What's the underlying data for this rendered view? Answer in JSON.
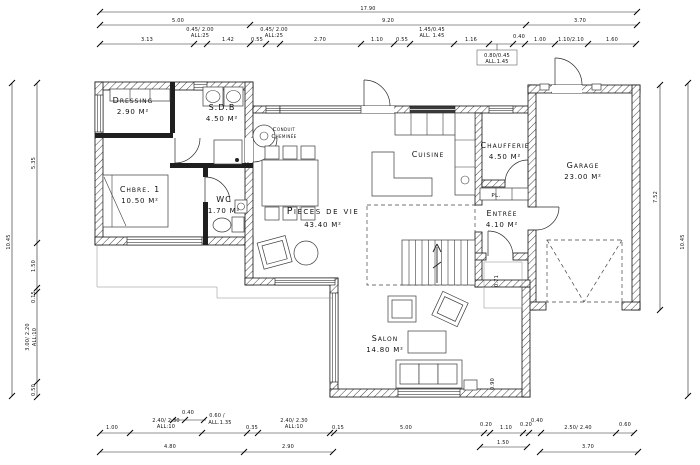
{
  "drawing": {
    "background": "#ffffff",
    "line_color": "#1a1a1a"
  },
  "rooms": [
    {
      "id": "dressing",
      "lines": [
        "Dressing",
        "2.90 M²"
      ],
      "x": 133,
      "y": 103
    },
    {
      "id": "sdb",
      "lines": [
        "S.D.B",
        "4.50 M²"
      ],
      "x": 222,
      "y": 110
    },
    {
      "id": "chbre-1",
      "lines": [
        "Chbre. 1",
        "10.50 M²"
      ],
      "x": 140,
      "y": 192
    },
    {
      "id": "wc",
      "lines": [
        "WC",
        "1.70 M²"
      ],
      "x": 224,
      "y": 202
    },
    {
      "id": "conduit",
      "lines": [
        "Conduit",
        "Cheminée"
      ],
      "x": 284,
      "y": 131,
      "small": true
    },
    {
      "id": "pieces-de-vie",
      "lines": [
        "Pièces de vie",
        "43.40 M²"
      ],
      "x": 323,
      "y": 214,
      "big": true
    },
    {
      "id": "cuisine",
      "lines": [
        "Cuisine"
      ],
      "x": 428,
      "y": 157
    },
    {
      "id": "chaufferie",
      "lines": [
        "Chaufferie",
        "4.50 M²"
      ],
      "x": 505,
      "y": 148
    },
    {
      "id": "pl",
      "lines": [
        "PL."
      ],
      "x": 496,
      "y": 197,
      "small": true
    },
    {
      "id": "entree",
      "lines": [
        "Entrée",
        "4.10 M²"
      ],
      "x": 502,
      "y": 216
    },
    {
      "id": "garage",
      "lines": [
        "Garage",
        "23.00 M²"
      ],
      "x": 583,
      "y": 168
    },
    {
      "id": "salon",
      "lines": [
        "Salon",
        "14.80 M²"
      ],
      "x": 385,
      "y": 341
    }
  ],
  "dim_lines": [
    {
      "o": "h",
      "y": 12,
      "x1": 100,
      "x2": 637,
      "ticks": [
        100,
        637
      ]
    },
    {
      "o": "h",
      "y": 25,
      "x1": 100,
      "x2": 638,
      "ticks": [
        100,
        250,
        526,
        637
      ]
    },
    {
      "o": "h",
      "y": 44,
      "x1": 100,
      "x2": 636,
      "ticks": [
        100,
        194,
        207,
        250,
        266,
        280,
        361,
        394,
        410,
        454,
        489,
        513,
        525,
        555,
        588,
        636
      ]
    },
    {
      "o": "h",
      "y": 420,
      "x1": 171,
      "x2": 206,
      "ticks": [
        173,
        185,
        204
      ]
    },
    {
      "o": "h",
      "y": 433,
      "x1": 100,
      "x2": 634,
      "ticks": [
        100,
        130,
        202,
        247,
        258,
        330,
        334,
        484,
        490,
        523,
        529,
        541,
        616,
        634
      ]
    },
    {
      "o": "h",
      "y": 447,
      "x1": 480,
      "x2": 527,
      "ticks": [
        480,
        527
      ]
    },
    {
      "o": "h",
      "y": 452,
      "x1": 100,
      "x2": 333,
      "ticks": [
        100,
        244,
        333
      ]
    },
    {
      "o": "h",
      "y": 452,
      "x1": 540,
      "x2": 638,
      "ticks": [
        540,
        638
      ]
    },
    {
      "o": "v",
      "x": 12,
      "y1": 83,
      "y2": 396,
      "ticks": [
        83,
        396
      ]
    },
    {
      "o": "v",
      "x": 37,
      "y1": 83,
      "y2": 397,
      "ticks": [
        83,
        243,
        288,
        292,
        382,
        397
      ]
    },
    {
      "o": "v",
      "x": 660,
      "y1": 85,
      "y2": 310,
      "ticks": [
        85,
        310
      ]
    },
    {
      "o": "v",
      "x": 688,
      "y1": 83,
      "y2": 396,
      "ticks": [
        83,
        396
      ]
    }
  ],
  "dim_labels": [
    {
      "t": "17.90",
      "x": 368,
      "y": 10
    },
    {
      "t": "5.00",
      "x": 178,
      "y": 22
    },
    {
      "t": "9.20",
      "x": 388,
      "y": 22
    },
    {
      "t": "3.70",
      "x": 580,
      "y": 22
    },
    {
      "t": "3.13",
      "x": 147,
      "y": 41
    },
    {
      "t": "0.45/ 2.00",
      "x": 200,
      "y": 31
    },
    {
      "t": "ALL:25",
      "x": 200,
      "y": 37
    },
    {
      "t": "1.42",
      "x": 228,
      "y": 41
    },
    {
      "t": "0.55",
      "x": 257,
      "y": 41
    },
    {
      "t": "0.45/ 2.00",
      "x": 274,
      "y": 31
    },
    {
      "t": "ALL:25",
      "x": 274,
      "y": 37
    },
    {
      "t": "2.70",
      "x": 320,
      "y": 41
    },
    {
      "t": "1.10",
      "x": 377,
      "y": 41
    },
    {
      "t": "0.55",
      "x": 402,
      "y": 41
    },
    {
      "t": "1.45/0.45",
      "x": 432,
      "y": 31
    },
    {
      "t": "ALL. 1.45",
      "x": 432,
      "y": 37
    },
    {
      "t": "1.16",
      "x": 471,
      "y": 41
    },
    {
      "t": "0.80/0.45",
      "x": 497,
      "y": 57
    },
    {
      "t": "ALL.1.45",
      "x": 497,
      "y": 63
    },
    {
      "t": "0.40",
      "x": 519,
      "y": 38
    },
    {
      "t": "1.00",
      "x": 540,
      "y": 41
    },
    {
      "t": "1.10/2.10",
      "x": 571,
      "y": 41
    },
    {
      "t": "1.60",
      "x": 612,
      "y": 41
    },
    {
      "t": "0.40",
      "x": 188,
      "y": 414
    },
    {
      "t": "0.60 /",
      "x": 217,
      "y": 417
    },
    {
      "t": "ALL.1.35",
      "x": 220,
      "y": 424
    },
    {
      "t": "1.00",
      "x": 112,
      "y": 429
    },
    {
      "t": "2.40/ 2.30",
      "x": 166,
      "y": 422
    },
    {
      "t": "ALL:10",
      "x": 166,
      "y": 428
    },
    {
      "t": "0.35",
      "x": 252,
      "y": 429
    },
    {
      "t": "2.40/ 2.30",
      "x": 294,
      "y": 422
    },
    {
      "t": "ALL:10",
      "x": 294,
      "y": 428
    },
    {
      "t": "0.15",
      "x": 338,
      "y": 429
    },
    {
      "t": "5.00",
      "x": 406,
      "y": 429
    },
    {
      "t": "0.20",
      "x": 486,
      "y": 426
    },
    {
      "t": "1.10",
      "x": 506,
      "y": 429
    },
    {
      "t": "0.20",
      "x": 526,
      "y": 426
    },
    {
      "t": "0.40",
      "x": 537,
      "y": 422
    },
    {
      "t": "2.50/ 2.40",
      "x": 578,
      "y": 429
    },
    {
      "t": "0.60",
      "x": 625,
      "y": 426
    },
    {
      "t": "1.50",
      "x": 503,
      "y": 444
    },
    {
      "t": "4.80",
      "x": 170,
      "y": 448
    },
    {
      "t": "2.90",
      "x": 288,
      "y": 448
    },
    {
      "t": "3.70",
      "x": 588,
      "y": 448
    },
    {
      "t": "10.45",
      "x": 10,
      "y": 242,
      "r": -90
    },
    {
      "t": "5.35",
      "x": 35,
      "y": 163,
      "r": -90
    },
    {
      "t": "1.50",
      "x": 35,
      "y": 266,
      "r": -90
    },
    {
      "t": "0.15",
      "x": 35,
      "y": 297,
      "r": -90
    },
    {
      "t": "3.00/ 2.20",
      "x": 29,
      "y": 337,
      "r": -90
    },
    {
      "t": "ALL:10",
      "x": 36,
      "y": 337,
      "r": -90
    },
    {
      "t": "0.50",
      "x": 35,
      "y": 390,
      "r": -90
    },
    {
      "t": "7.52",
      "x": 657,
      "y": 197,
      "r": -90
    },
    {
      "t": "10.45",
      "x": 684,
      "y": 242,
      "r": -90
    },
    {
      "t": "0.71",
      "x": 498,
      "y": 281,
      "r": -90
    },
    {
      "t": "0.90",
      "x": 494,
      "y": 384,
      "r": -90
    }
  ]
}
